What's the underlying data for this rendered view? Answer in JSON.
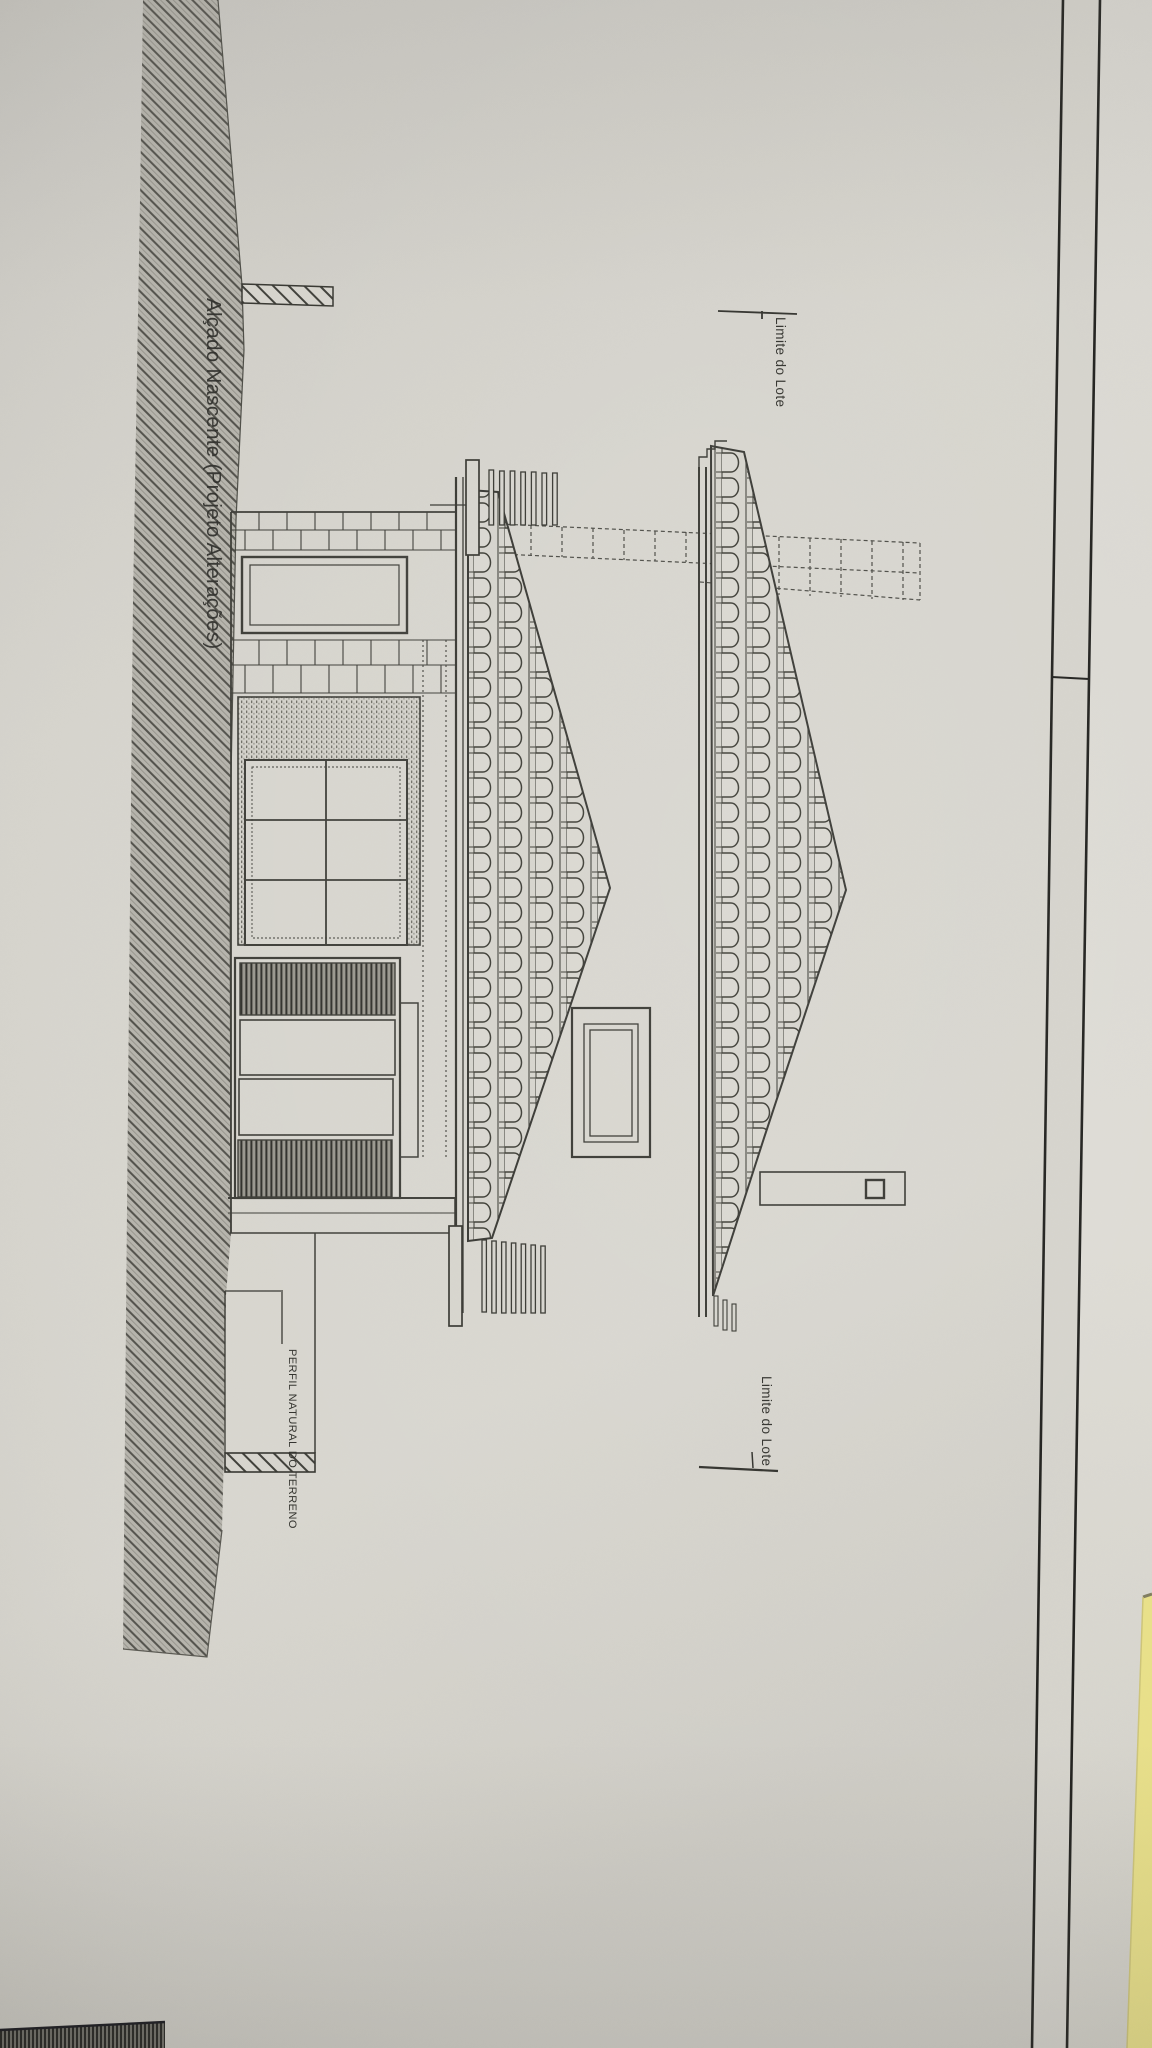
{
  "sheet": {
    "title": "Alçado Nascente (Projeto Alterações)",
    "labels": {
      "lot_boundary_top": "Limite do Lote",
      "lot_boundary_bottom": "Limite do Lote",
      "terrain_profile": "PERFIL NATURAL DO TERRENO"
    },
    "colors": {
      "paper": "#d3d1ca",
      "ink": "#33332e",
      "hatch_band": "#8e8c85",
      "under_sheet": "#d5d3cc",
      "yellow_sheet": "#e9e087"
    }
  }
}
